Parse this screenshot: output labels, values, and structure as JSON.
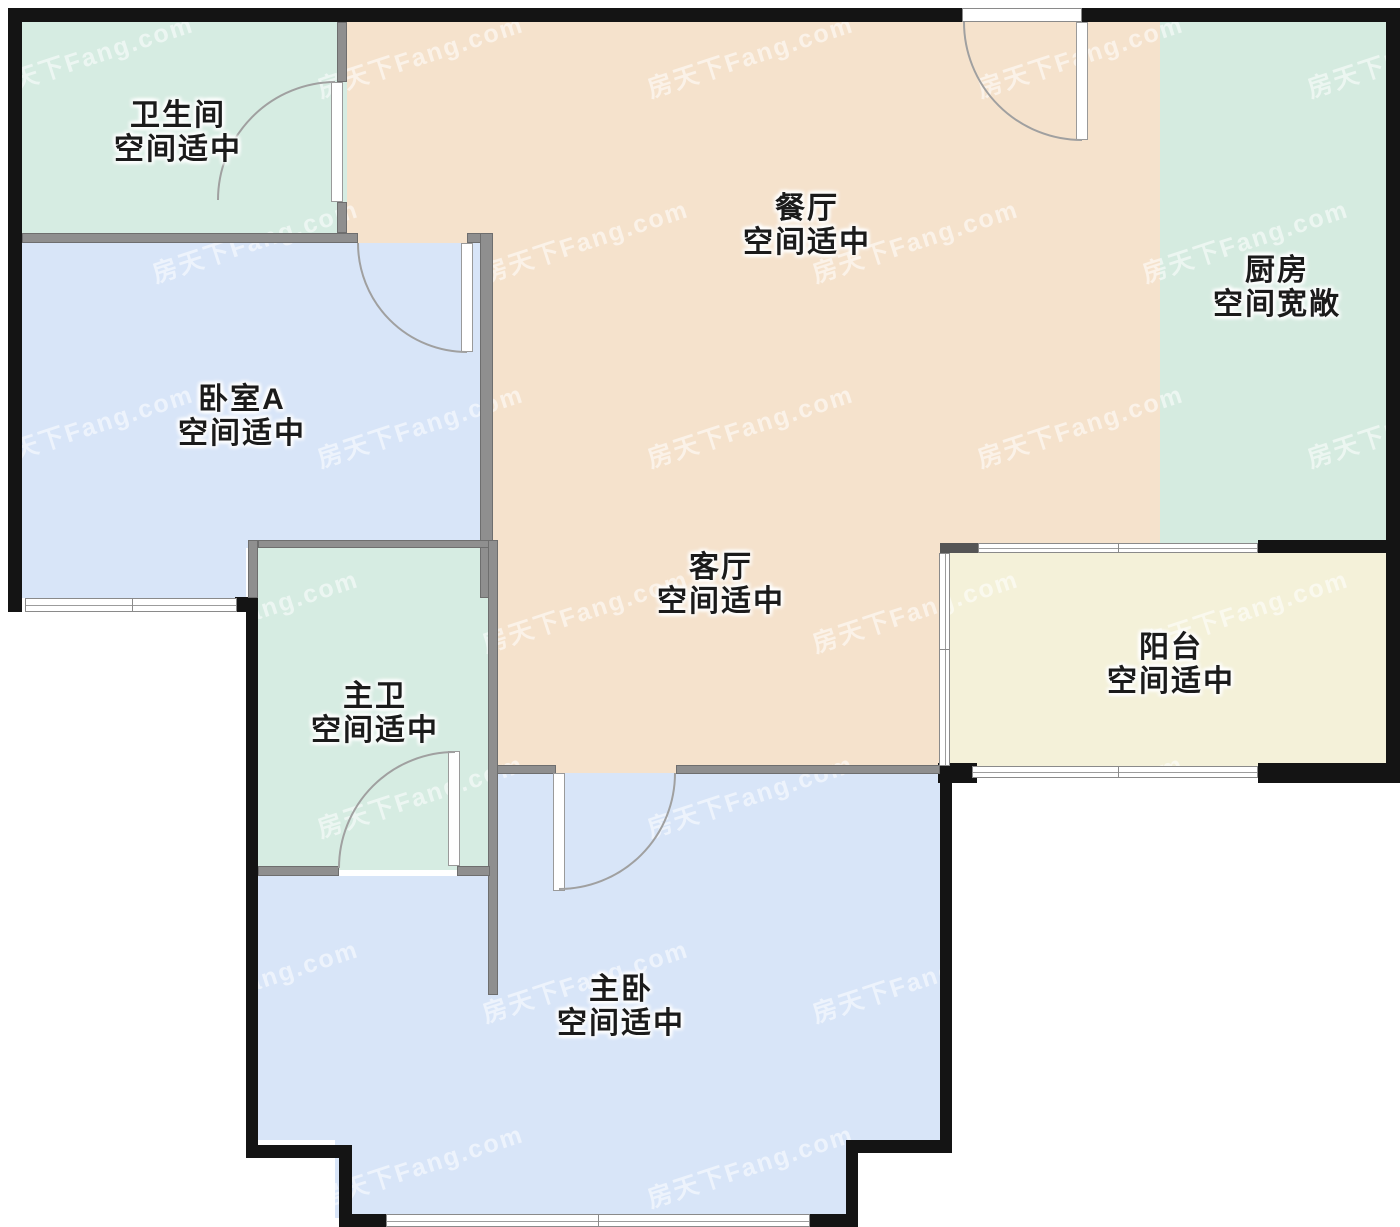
{
  "watermark": {
    "text": "房天下Fang.com"
  },
  "rooms": {
    "bathroom": {
      "name": "卫生间",
      "note": "空间适中",
      "fill": "#d6ece2"
    },
    "dining": {
      "name": "餐厅",
      "note": "空间适中",
      "fill": "#f5e2cc"
    },
    "kitchen": {
      "name": "厨房",
      "note": "空间宽敞",
      "fill": "#d5ebe0"
    },
    "bedroom_a": {
      "name": "卧室A",
      "note": "空间适中",
      "fill": "#d8e5f8"
    },
    "living": {
      "name": "客厅",
      "note": "空间适中",
      "fill": "#f5e2cc"
    },
    "master_bath": {
      "name": "主卫",
      "note": "空间适中",
      "fill": "#d6ece2"
    },
    "balcony": {
      "name": "阳台",
      "note": "空间适中",
      "fill": "#f4f1d9"
    },
    "master_bedroom": {
      "name": "主卧",
      "note": "空间适中",
      "fill": "#d8e5f8"
    }
  },
  "colors": {
    "exterior_wall": "#141414",
    "interior_wall": "#8f8f8f",
    "door_arc": "#a0a0a0",
    "window_frame": "#8a8a8a",
    "label_text": "#1b1b1b"
  }
}
